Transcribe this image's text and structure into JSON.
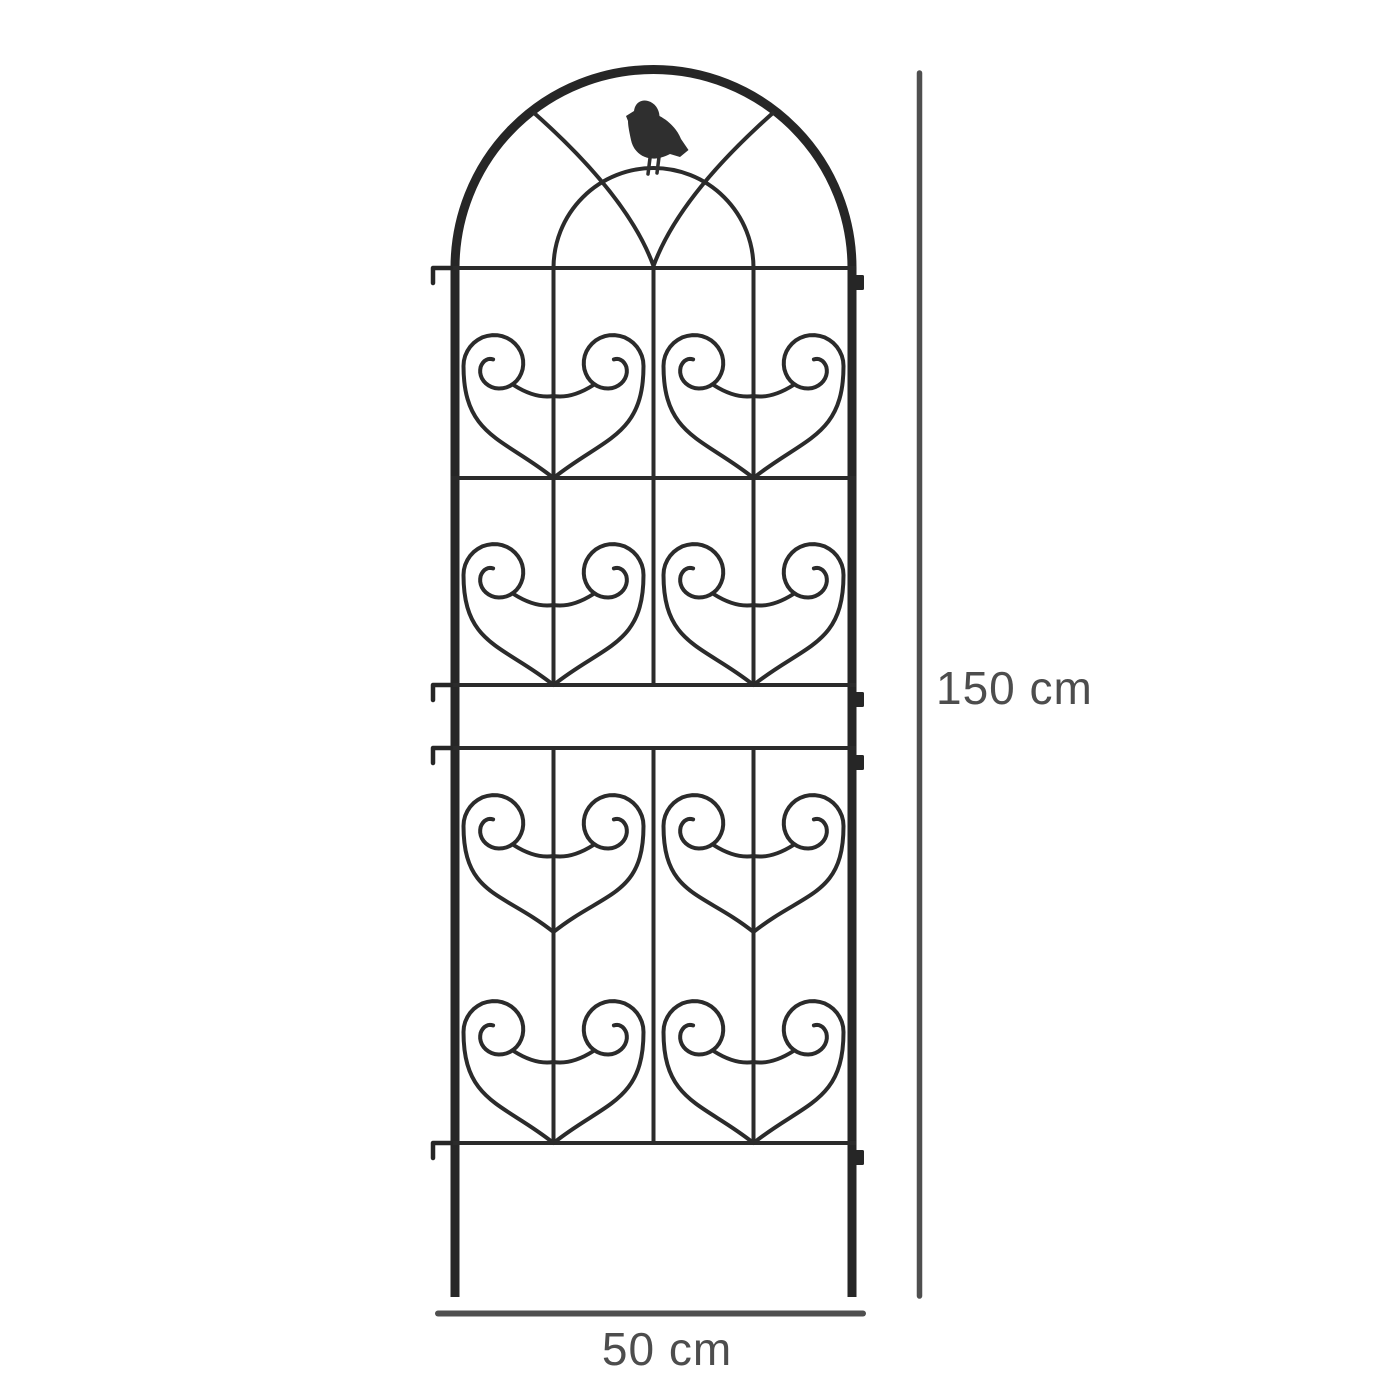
{
  "diagram": {
    "subject": "metal garden trellis panel with arched top, bird silhouette and scroll hearts"
  },
  "dimensions": {
    "height": {
      "label": "150 cm",
      "value": 150,
      "unit": "cm"
    },
    "width": {
      "label": "50 cm",
      "value": 50,
      "unit": "cm"
    }
  },
  "colors": {
    "background": "#ffffff",
    "trellis_frame": "#262626",
    "trellis_wire": "#2b2b2b",
    "bird": "#2f2f2f",
    "dimension_line": "#4f4f4f",
    "dimension_text": "#4d4d4d"
  }
}
